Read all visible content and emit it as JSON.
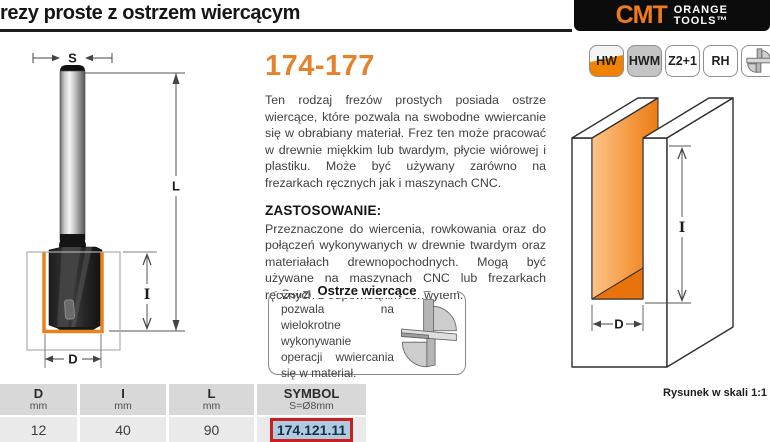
{
  "header": {
    "title": "rezy proste z ostrzem wiercącym"
  },
  "logo": {
    "brand": "CMT",
    "line1": "ORANGE",
    "line2": "TOOLS",
    "tm": "™"
  },
  "badges": [
    {
      "label": "HW"
    },
    {
      "label": "HWM"
    },
    {
      "label": "Z2+1"
    },
    {
      "label": "RH"
    },
    {
      "label": "",
      "icon": "cutter-profile-icon"
    }
  ],
  "product": {
    "code": "174-177",
    "description": "Ten rodzaj frezów prostych posiada ostrze wiercące, które pozwala na swobodne wwiercanie się w obrabiany materiał. Frez ten może pracować w drewnie miękkim lub twardym, płycie wiórowej i plastiku. Może być używany zarówno na frezarkach ręcznych jak i maszynach CNC.",
    "application_title": "ZASTOSOWANIE:",
    "application_text": "Przeznaczone do wiercenia, rowkowania oraz do połączeń wykonywanych w drewnie twardym oraz materiałach drewnopochodnych. Mogą być używane na maszynach CNC lub frezarkach ręcznych z odpowiednim uchwytem."
  },
  "callout": {
    "title": "Ostrze wiercące",
    "text": "Ostrze wiercące pozwala na wielokrotne wykonywanie operacji wwiercania się w materiał."
  },
  "dims": {
    "s": "S",
    "l": "L",
    "i": "I",
    "d": "D"
  },
  "diagram": {
    "scale_note": "Rysunek w skali 1:1"
  },
  "table": {
    "columns": [
      {
        "label": "D",
        "sub": "mm"
      },
      {
        "label": "I",
        "sub": "mm"
      },
      {
        "label": "L",
        "sub": "mm"
      },
      {
        "label": "SYMBOL",
        "sub": "S=Ø8mm"
      }
    ],
    "rows": [
      [
        "12",
        "40",
        "90",
        "174.121.11"
      ]
    ]
  },
  "colors": {
    "accent": "#e8821f",
    "logo_bg": "#0c0c0c",
    "highlight_border": "#c9201d",
    "highlight_bg": "#aecbe0",
    "table_header_bg": "#d8d8d8"
  }
}
